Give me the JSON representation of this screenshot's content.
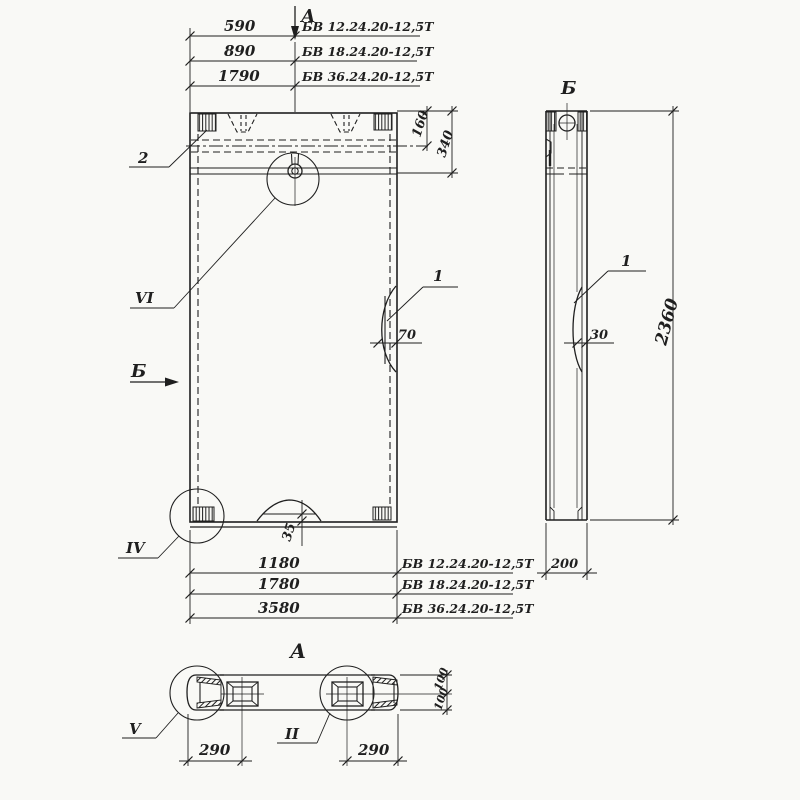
{
  "colors": {
    "ink": "#1f1f1f",
    "paper": "#f9f9f6"
  },
  "labels": {
    "section_cut_top": "А",
    "section_cut_side": "Б",
    "view_side_title": "Б",
    "section_view_title": "А"
  },
  "top_dimensions": [
    {
      "value": "590",
      "mark": "БВ 12.24.20-12,5Т"
    },
    {
      "value": "890",
      "mark": "БВ 18.24.20-12,5Т"
    },
    {
      "value": "1790",
      "mark": "БВ 36.24.20-12,5Т"
    }
  ],
  "bottom_dimensions": [
    {
      "value": "1180",
      "mark": "БВ 12.24.20-12,5Т"
    },
    {
      "value": "1780",
      "mark": "БВ 18.24.20-12,5Т"
    },
    {
      "value": "3580",
      "mark": "БВ 36.24.20-12,5Т"
    }
  ],
  "dimensions": {
    "top_inset_1": "160",
    "top_inset_2": "340",
    "front_recess_width": "70",
    "side_recess_depth": "30",
    "panel_height": "2360",
    "panel_thickness": "200",
    "bottom_hump": "35",
    "anchor_offset_left": "290",
    "anchor_offset_right": "290",
    "edge_top": "100",
    "edge_bottom": "100"
  },
  "callouts": {
    "block_top": "2",
    "eye_detail": "VI",
    "block_bottom": "IV",
    "end_detail": "V",
    "anchor_detail": "II",
    "recess_front": "1",
    "recess_side": "1"
  }
}
